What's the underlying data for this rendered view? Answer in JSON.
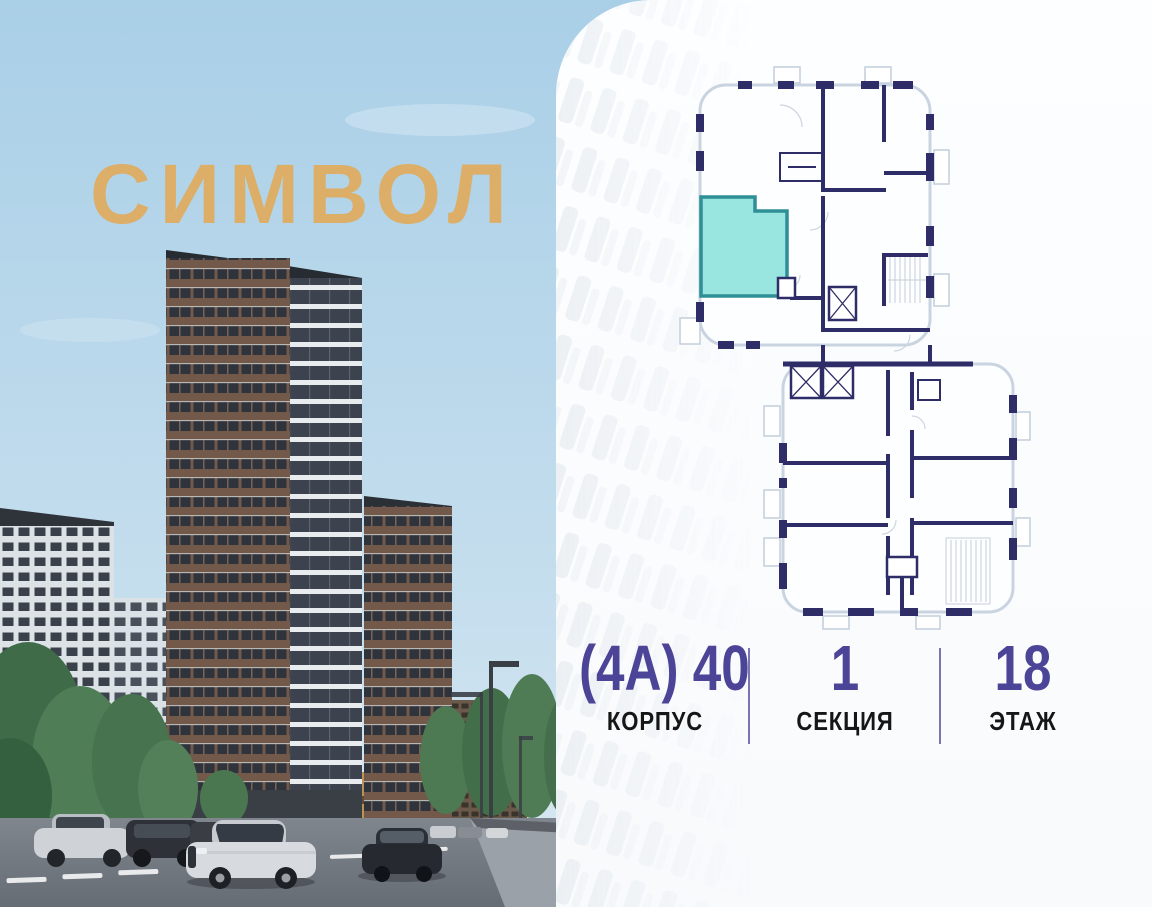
{
  "brand": {
    "name": "СИМВОЛ"
  },
  "colors": {
    "brand": "#dcae67",
    "accent": "#4c4497",
    "label": "#161616",
    "divider": "#7a74b4",
    "wall": "#2e2d68",
    "outline": "#c9d4e0",
    "hl_fill": "#99e5e0",
    "hl_stroke": "#2e8f96"
  },
  "unit_info": {
    "items": [
      {
        "value": "(4А) 40",
        "label": "КОРПУС"
      },
      {
        "value": "1",
        "label": "СЕКЦИЯ"
      },
      {
        "value": "18",
        "label": "ЭТАЖ"
      }
    ]
  }
}
